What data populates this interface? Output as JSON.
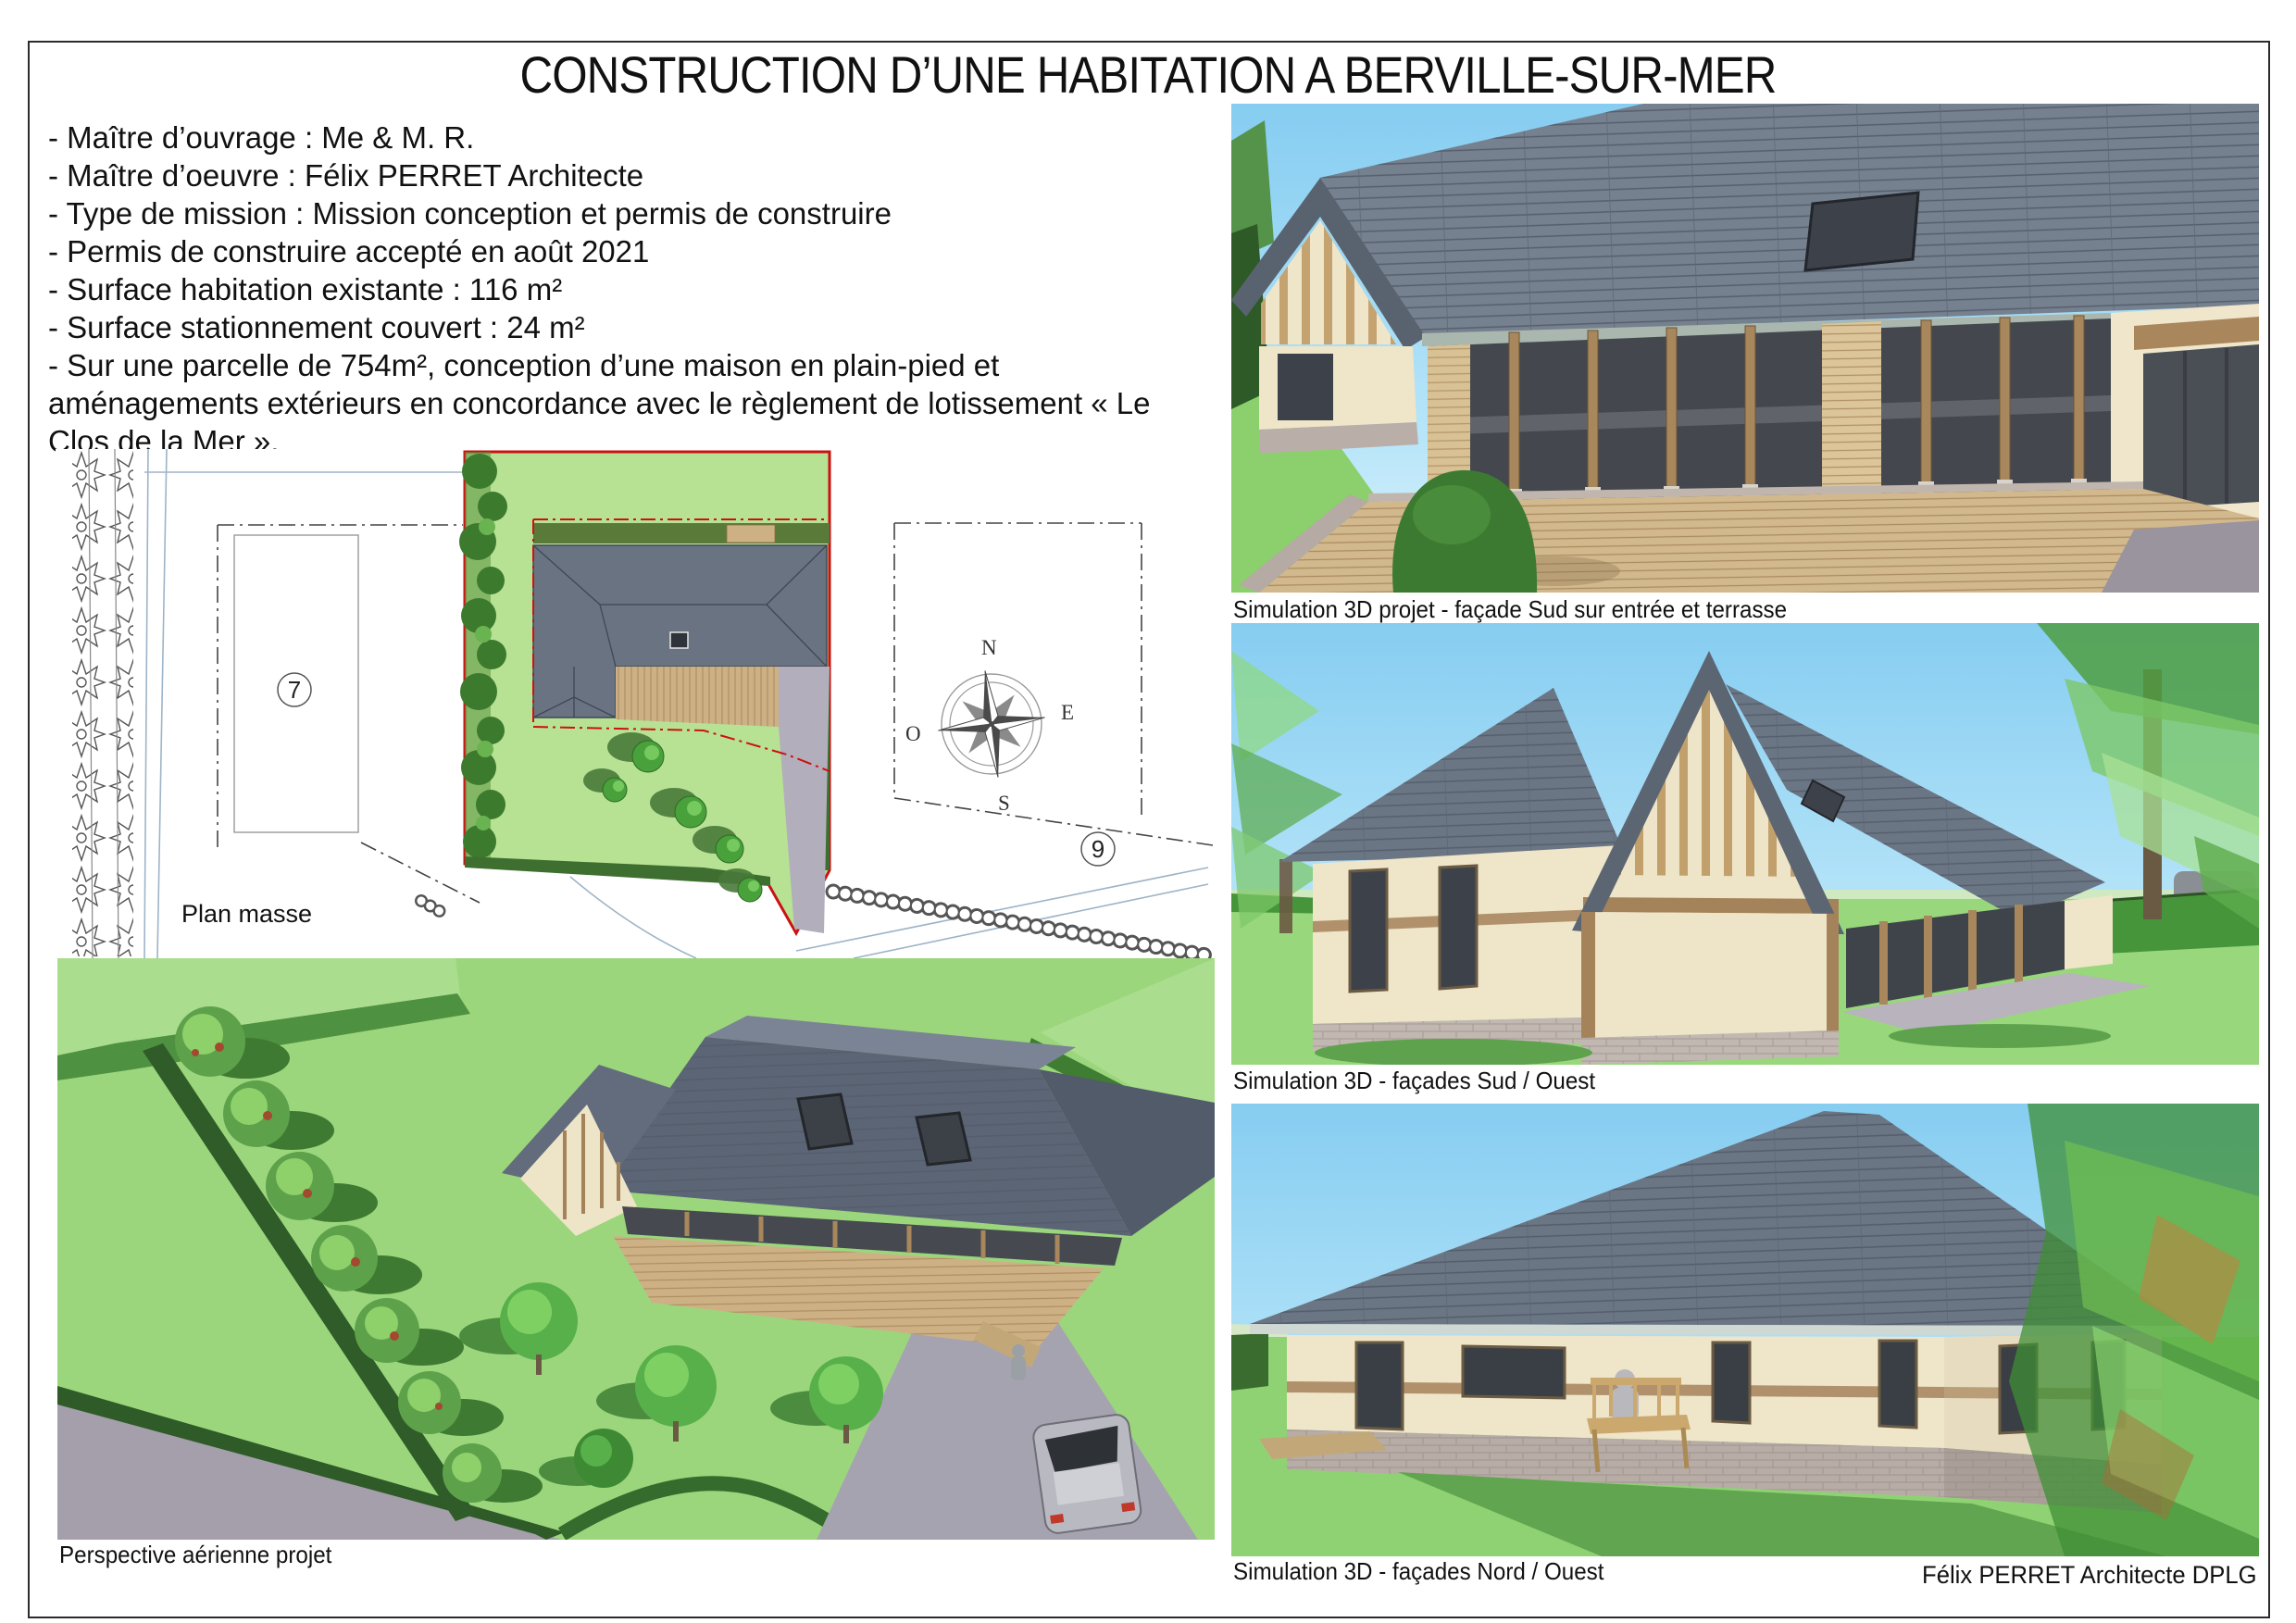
{
  "sheet": {
    "title": "CONSTRUCTION D’UNE HABITATION A BERVILLE-SUR-MER",
    "signature": "Félix PERRET Architecte DPLG"
  },
  "project_info": {
    "items": [
      "- Maître d’ouvrage : Me & M. R.",
      "- Maître d’oeuvre : Félix PERRET Architecte",
      "- Type de mission : Mission conception et permis de construire",
      "- Permis de construire accepté en août 2021",
      "- Surface habitation existante : 116 m²",
      "- Surface stationnement couvert : 24 m²",
      "- Sur une parcelle de 754m², conception d’une maison en plain-pied et aménagements extérieurs en concordance avec le règlement de lotissement « Le Clos de la Mer »."
    ]
  },
  "site_plan": {
    "label": "Plan masse",
    "parcel_left_number": "7",
    "parcel_right_number": "9",
    "compass": {
      "n": "N",
      "e": "E",
      "s": "S",
      "o": "O"
    }
  },
  "figures": {
    "sud_entree": {
      "caption": "Simulation 3D projet - façade Sud sur entrée et terrasse"
    },
    "sud_ouest": {
      "caption": "Simulation 3D - façades Sud / Ouest"
    },
    "nord_ouest": {
      "caption": "Simulation 3D - façades Nord / Ouest"
    },
    "aerienne": {
      "caption": "Perspective aérienne projet"
    }
  },
  "palette": {
    "roof_slate": "#76818f",
    "roof_lines": "#4f5866",
    "wall_cream": "#efe5c9",
    "timber_wood": "#a5835a",
    "brick_base": "#bcb1ab",
    "deck_wood": "#d2b88d",
    "grass_green": "#93d374",
    "hedge_dark": "#2f5c28",
    "sky_blue": "#8ed2f3",
    "driveway_grey": "#a6a3b0",
    "boundary_red": "#cc1111"
  }
}
